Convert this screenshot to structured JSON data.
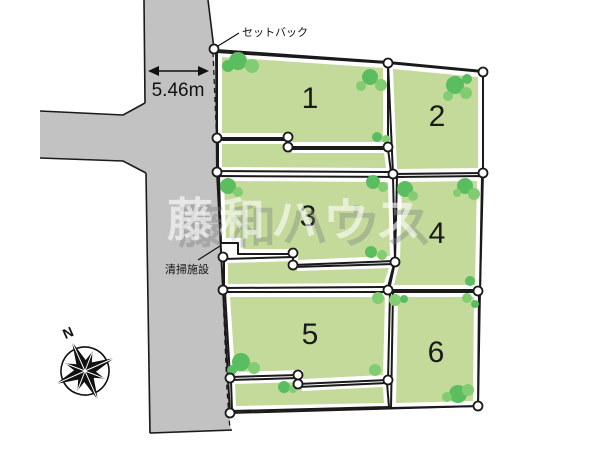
{
  "diagram": {
    "watermark": "藤和ハウス",
    "compass": {
      "north_label": "N"
    },
    "road": {
      "width_label": "5.46m"
    },
    "annotations": {
      "setback": "セットバック",
      "cleaning_facility": "清掃施設"
    },
    "plots": [
      {
        "number": "1"
      },
      {
        "number": "2"
      },
      {
        "number": "3"
      },
      {
        "number": "4"
      },
      {
        "number": "5"
      },
      {
        "number": "6"
      }
    ],
    "colors": {
      "road_gray": "#c2c2c2",
      "lot_green": "#c3da9b",
      "tree_dark": "#5abd60",
      "tree_light": "#82cc71",
      "line_black": "#1a1a1a",
      "marker_fill": "#ffffff",
      "background": "#ffffff"
    }
  }
}
